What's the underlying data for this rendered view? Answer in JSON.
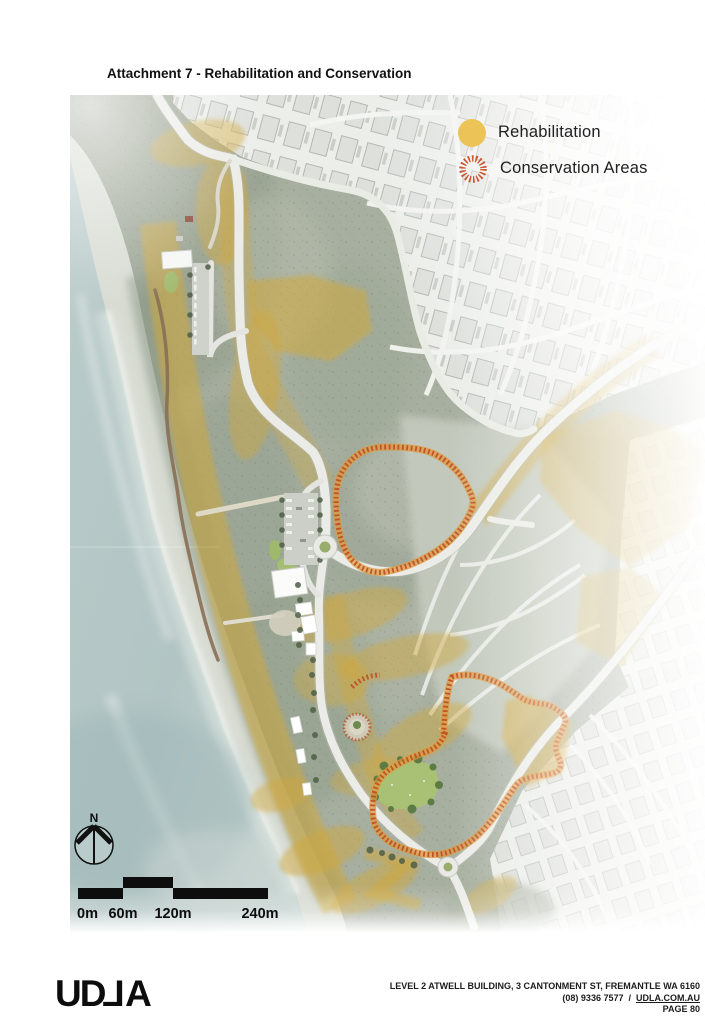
{
  "header": {
    "title": "Attachment 7 - Rehabilitation and Conservation"
  },
  "legend": {
    "items": [
      {
        "label": "Rehabilitation",
        "swatch": "filled-circle",
        "color": "#ebc356"
      },
      {
        "label": "Conservation Areas",
        "swatch": "hatched-ring",
        "color": "#cd5430"
      }
    ]
  },
  "map": {
    "type": "aerial-masterplan-illustration",
    "compass": {
      "label": "N"
    },
    "scale_bar": {
      "labels": [
        "0m",
        "60m",
        "120m",
        "240m"
      ]
    }
  },
  "footer": {
    "logo_parts": [
      "UD",
      "L",
      "A"
    ],
    "address_line": "LEVEL 2 ATWELL BUILDING, 3 CANTONMENT ST, FREMANTLE WA 6160",
    "phone": "(08) 9336 7577",
    "separator": "/",
    "website": "UDLA.COM.AU",
    "page_label": "PAGE 80"
  },
  "colors": {
    "rehabilitation_yellow": "#d0a83c",
    "conservation_red": "#bf4c26",
    "ocean": "#b4c7c6",
    "scrub": "#a7afa0",
    "lawn": "#a8c175"
  }
}
